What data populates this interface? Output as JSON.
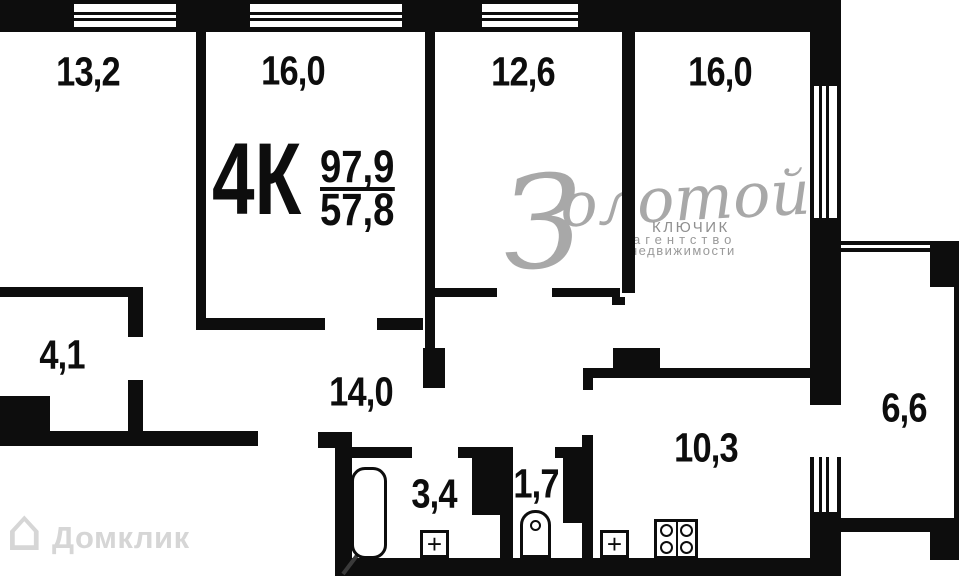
{
  "floor_plan": {
    "title": {
      "type_label": "4К",
      "area_total": "97,9",
      "area_living": "57,8"
    },
    "rooms": [
      {
        "name": "room-top-1",
        "label": "13,2"
      },
      {
        "name": "room-top-2",
        "label": "16,0"
      },
      {
        "name": "room-top-3",
        "label": "12,6"
      },
      {
        "name": "room-top-4",
        "label": "16,0"
      },
      {
        "name": "storage",
        "label": "4,1"
      },
      {
        "name": "hallway",
        "label": "14,0"
      },
      {
        "name": "bathroom",
        "label": "3,4"
      },
      {
        "name": "wc",
        "label": "1,7"
      },
      {
        "name": "kitchen",
        "label": "10,3"
      },
      {
        "name": "balcony",
        "label": "6,6"
      }
    ],
    "watermarks": {
      "agency_script": "Золотой",
      "agency_line1": "КЛЮЧИК",
      "agency_line2": "агентство",
      "agency_line3": "недвижимости",
      "portal_label": "Домклик",
      "portal_icon": "⌂"
    },
    "colors": {
      "wall": "#0d0d0d",
      "background": "#ffffff",
      "agency_watermark": "#a8a8a8",
      "portal_watermark": "#d6d6d6"
    }
  }
}
